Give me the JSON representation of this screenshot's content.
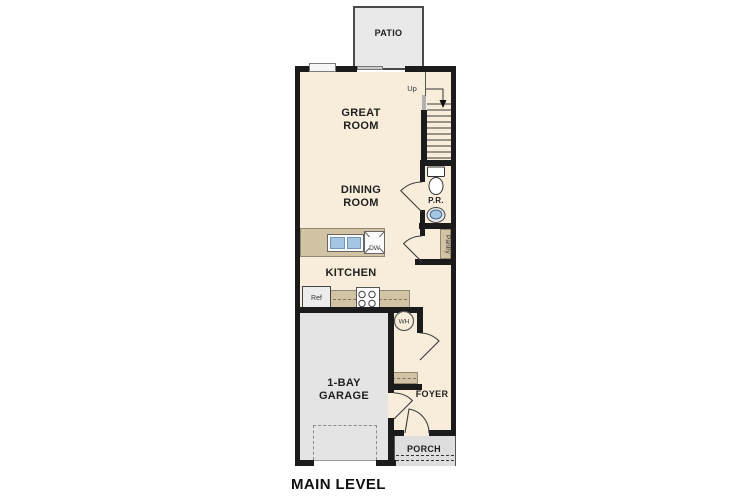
{
  "plan": {
    "title": "MAIN LEVEL"
  },
  "rooms": {
    "patio": "PATIO",
    "great_room": "GREAT\nROOM",
    "dining_room": "DINING\nROOM",
    "kitchen": "KITCHEN",
    "garage": "1-BAY\nGARAGE",
    "foyer": "FOYER",
    "porch": "PORCH",
    "powder_room": "P.R.",
    "pantry": "Pantry"
  },
  "annotations": {
    "stairs_direction": "Up"
  },
  "appliances": {
    "refrigerator": "Ref",
    "dishwasher": "DW",
    "water_heater": "WH"
  },
  "colors": {
    "wall": "#1b1b1b",
    "interior_floor": "#f8eddb",
    "casework_tan": "#d3c3a5",
    "concrete_gray": "#e4e4e4",
    "sink_blue": "#a4c6e3"
  }
}
